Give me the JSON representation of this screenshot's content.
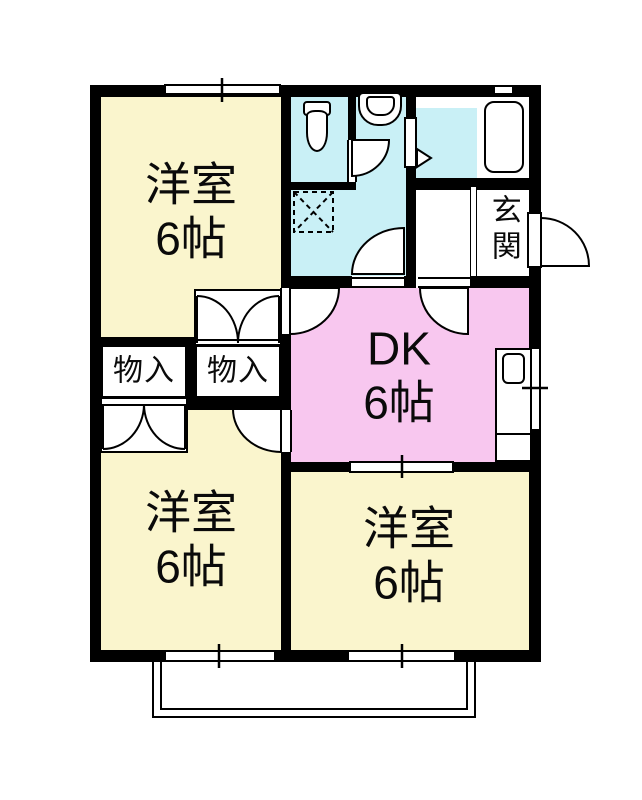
{
  "plan_title": "2DK apartment floor plan",
  "rooms": {
    "western_top_left": {
      "name": "洋室",
      "size": "6帖"
    },
    "western_bottom_left": {
      "name": "洋室",
      "size": "6帖"
    },
    "western_bottom_right": {
      "name": "洋室",
      "size": "6帖"
    },
    "dining_kitchen": {
      "name": "DK",
      "size": "6帖"
    },
    "entrance": {
      "name": "玄関"
    },
    "closet_upper": {
      "name": "物入"
    },
    "closet_lower": {
      "name": "物入"
    }
  },
  "fixtures": {
    "toilet": "toilet-icon",
    "washbasin": "washbasin-icon",
    "washer_pan": "washing-machine-pan-icon",
    "bathtub": "bathtub-icon",
    "kitchen_sink": "kitchen-sink-icon",
    "front_door": "entrance-door-swing",
    "balcony": "balcony-outline"
  },
  "colors": {
    "room_yellow": "#faf5cd",
    "dk_pink": "#f8c7ef",
    "wet_area_cyan": "#c9f0f6",
    "wall_black": "#000000",
    "background": "#ffffff"
  }
}
